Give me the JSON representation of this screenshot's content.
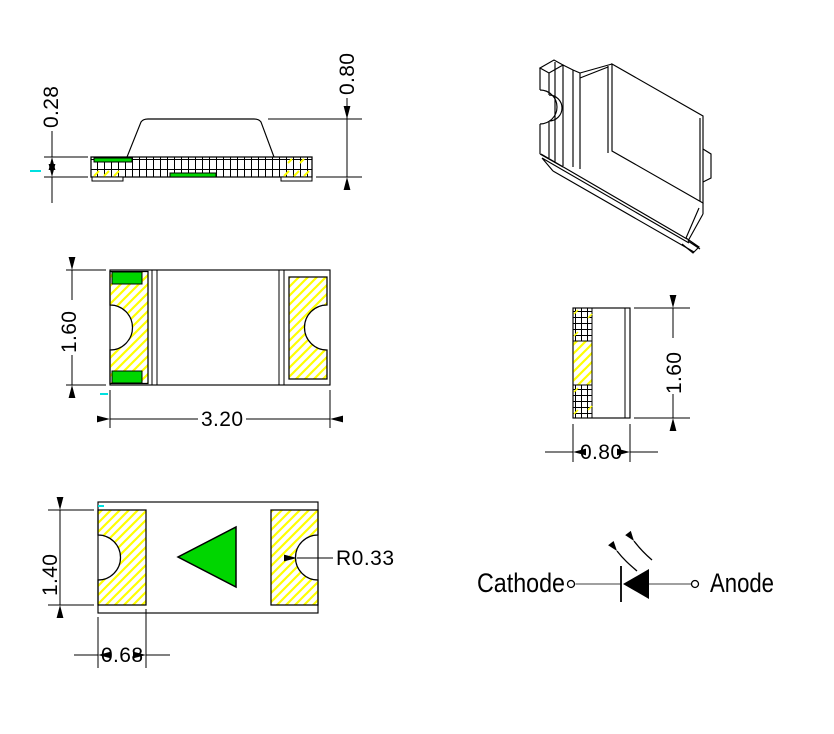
{
  "views": {
    "side": {
      "substrate_thickness": "0.28",
      "total_height": "0.80"
    },
    "top": {
      "height": "1.60",
      "width": "3.20"
    },
    "end": {
      "width": "0.80",
      "height": "1.60"
    },
    "bottom": {
      "pad_height": "1.40",
      "pad_width": "0.68",
      "notch_radius": "R0.33"
    },
    "schematic": {
      "cathode_label": "Cathode",
      "anode_label": "Anode"
    }
  },
  "colors": {
    "line": "#000000",
    "polarity_green": "#00d600",
    "hatch_yellow": "#ffff00",
    "wire_gray": "#808080",
    "artifact_cyan": "#00e0e0",
    "background": "#ffffff"
  }
}
